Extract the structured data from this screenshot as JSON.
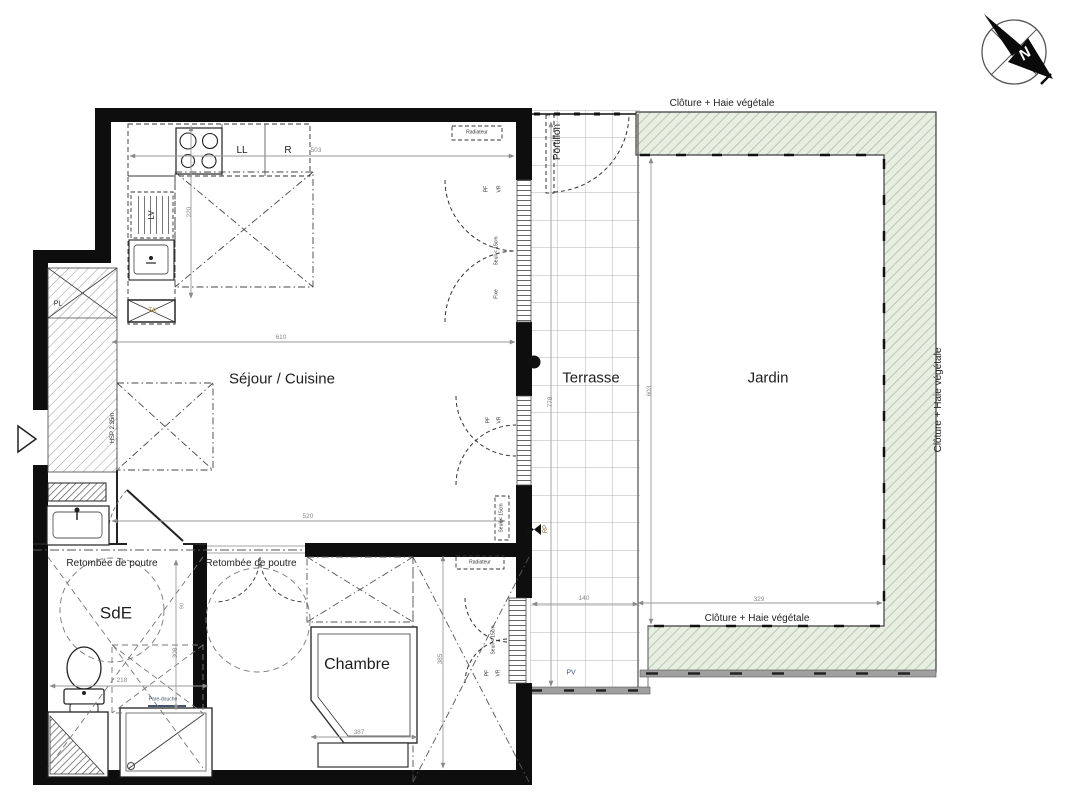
{
  "plan": {
    "compass_north": "N",
    "rooms": {
      "sejour": "Séjour / Cuisine",
      "terrasse": "Terrasse",
      "jardin": "Jardin",
      "chambre": "Chambre",
      "sde": "SdE"
    },
    "fence": {
      "top": "Clôture + Haie végétale",
      "bottom": "Clôture + Haie végétale",
      "right": "Clôture + Haie végétale",
      "gate": "Portillon"
    },
    "annotations": {
      "beam_left": "Retombée de poutre",
      "beam_right": "Retombée de poutre",
      "radiator_living": "Radiateur",
      "radiator_bedroom": "Radiateur",
      "ceiling_height": "HSP 2.35m",
      "closet": "PL",
      "electrical_panel": "TA",
      "washing_machine": "LL",
      "fridge": "R",
      "dishwasher": "LV",
      "outdoor_tap": "RP",
      "pv": "PV",
      "shower_screen": "Pare-douche"
    },
    "window_tags": {
      "pf1": "PF",
      "vr1": "VR",
      "seuil1": "Seuil < 15cm",
      "fixe1": "Fixe",
      "pf2": "PF",
      "vr2": "VR",
      "seuil2": "Seuil < 15cm",
      "pf3": "PF",
      "vr3": "VR",
      "seuil3": "Seuil < 15cm"
    },
    "dimensions": {
      "living_width": "610",
      "kitchen_width": "503",
      "kitchen_depth": "220",
      "living_south": "520",
      "sde_width": "218",
      "sde_depth": "308",
      "sde_door": "90",
      "bed_width": "387",
      "bedroom_depth": "385",
      "terrace_depth": "778",
      "garden_depth": "603",
      "garden_width": "329",
      "terrace_south": "140"
    }
  }
}
